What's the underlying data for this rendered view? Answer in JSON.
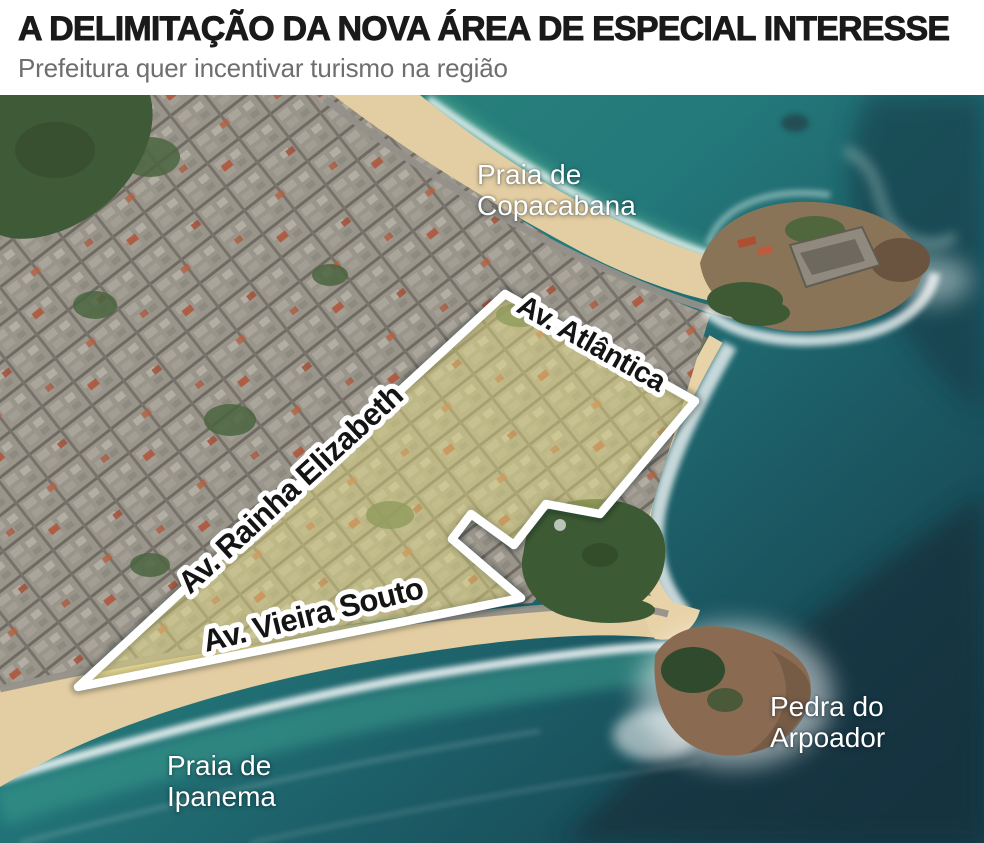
{
  "header": {
    "title": "A DELIMITAÇÃO DA NOVA ÁREA DE ESPECIAL INTERESSE",
    "subtitle": "Prefeitura quer incentivar turismo na região"
  },
  "map": {
    "place_labels": {
      "copacabana": {
        "line1": "Praia de",
        "line2": "Copacabana"
      },
      "arpoador": {
        "line1": "Pedra do",
        "line2": "Arpoador"
      },
      "ipanema": {
        "line1": "Praia de",
        "line2": "Ipanema"
      }
    },
    "street_labels": {
      "atlantica": "Av. Atlântica",
      "rainha_elizabeth": "Av. Rainha Elizabeth",
      "vieira_souto": "Av. Vieira Souto"
    },
    "colors": {
      "highlight_fill": "#eae282",
      "outline": "#ffffff",
      "ocean_teal": "#2e8a7d",
      "ocean_deep": "#143844",
      "sand": "#e3cda2"
    }
  }
}
